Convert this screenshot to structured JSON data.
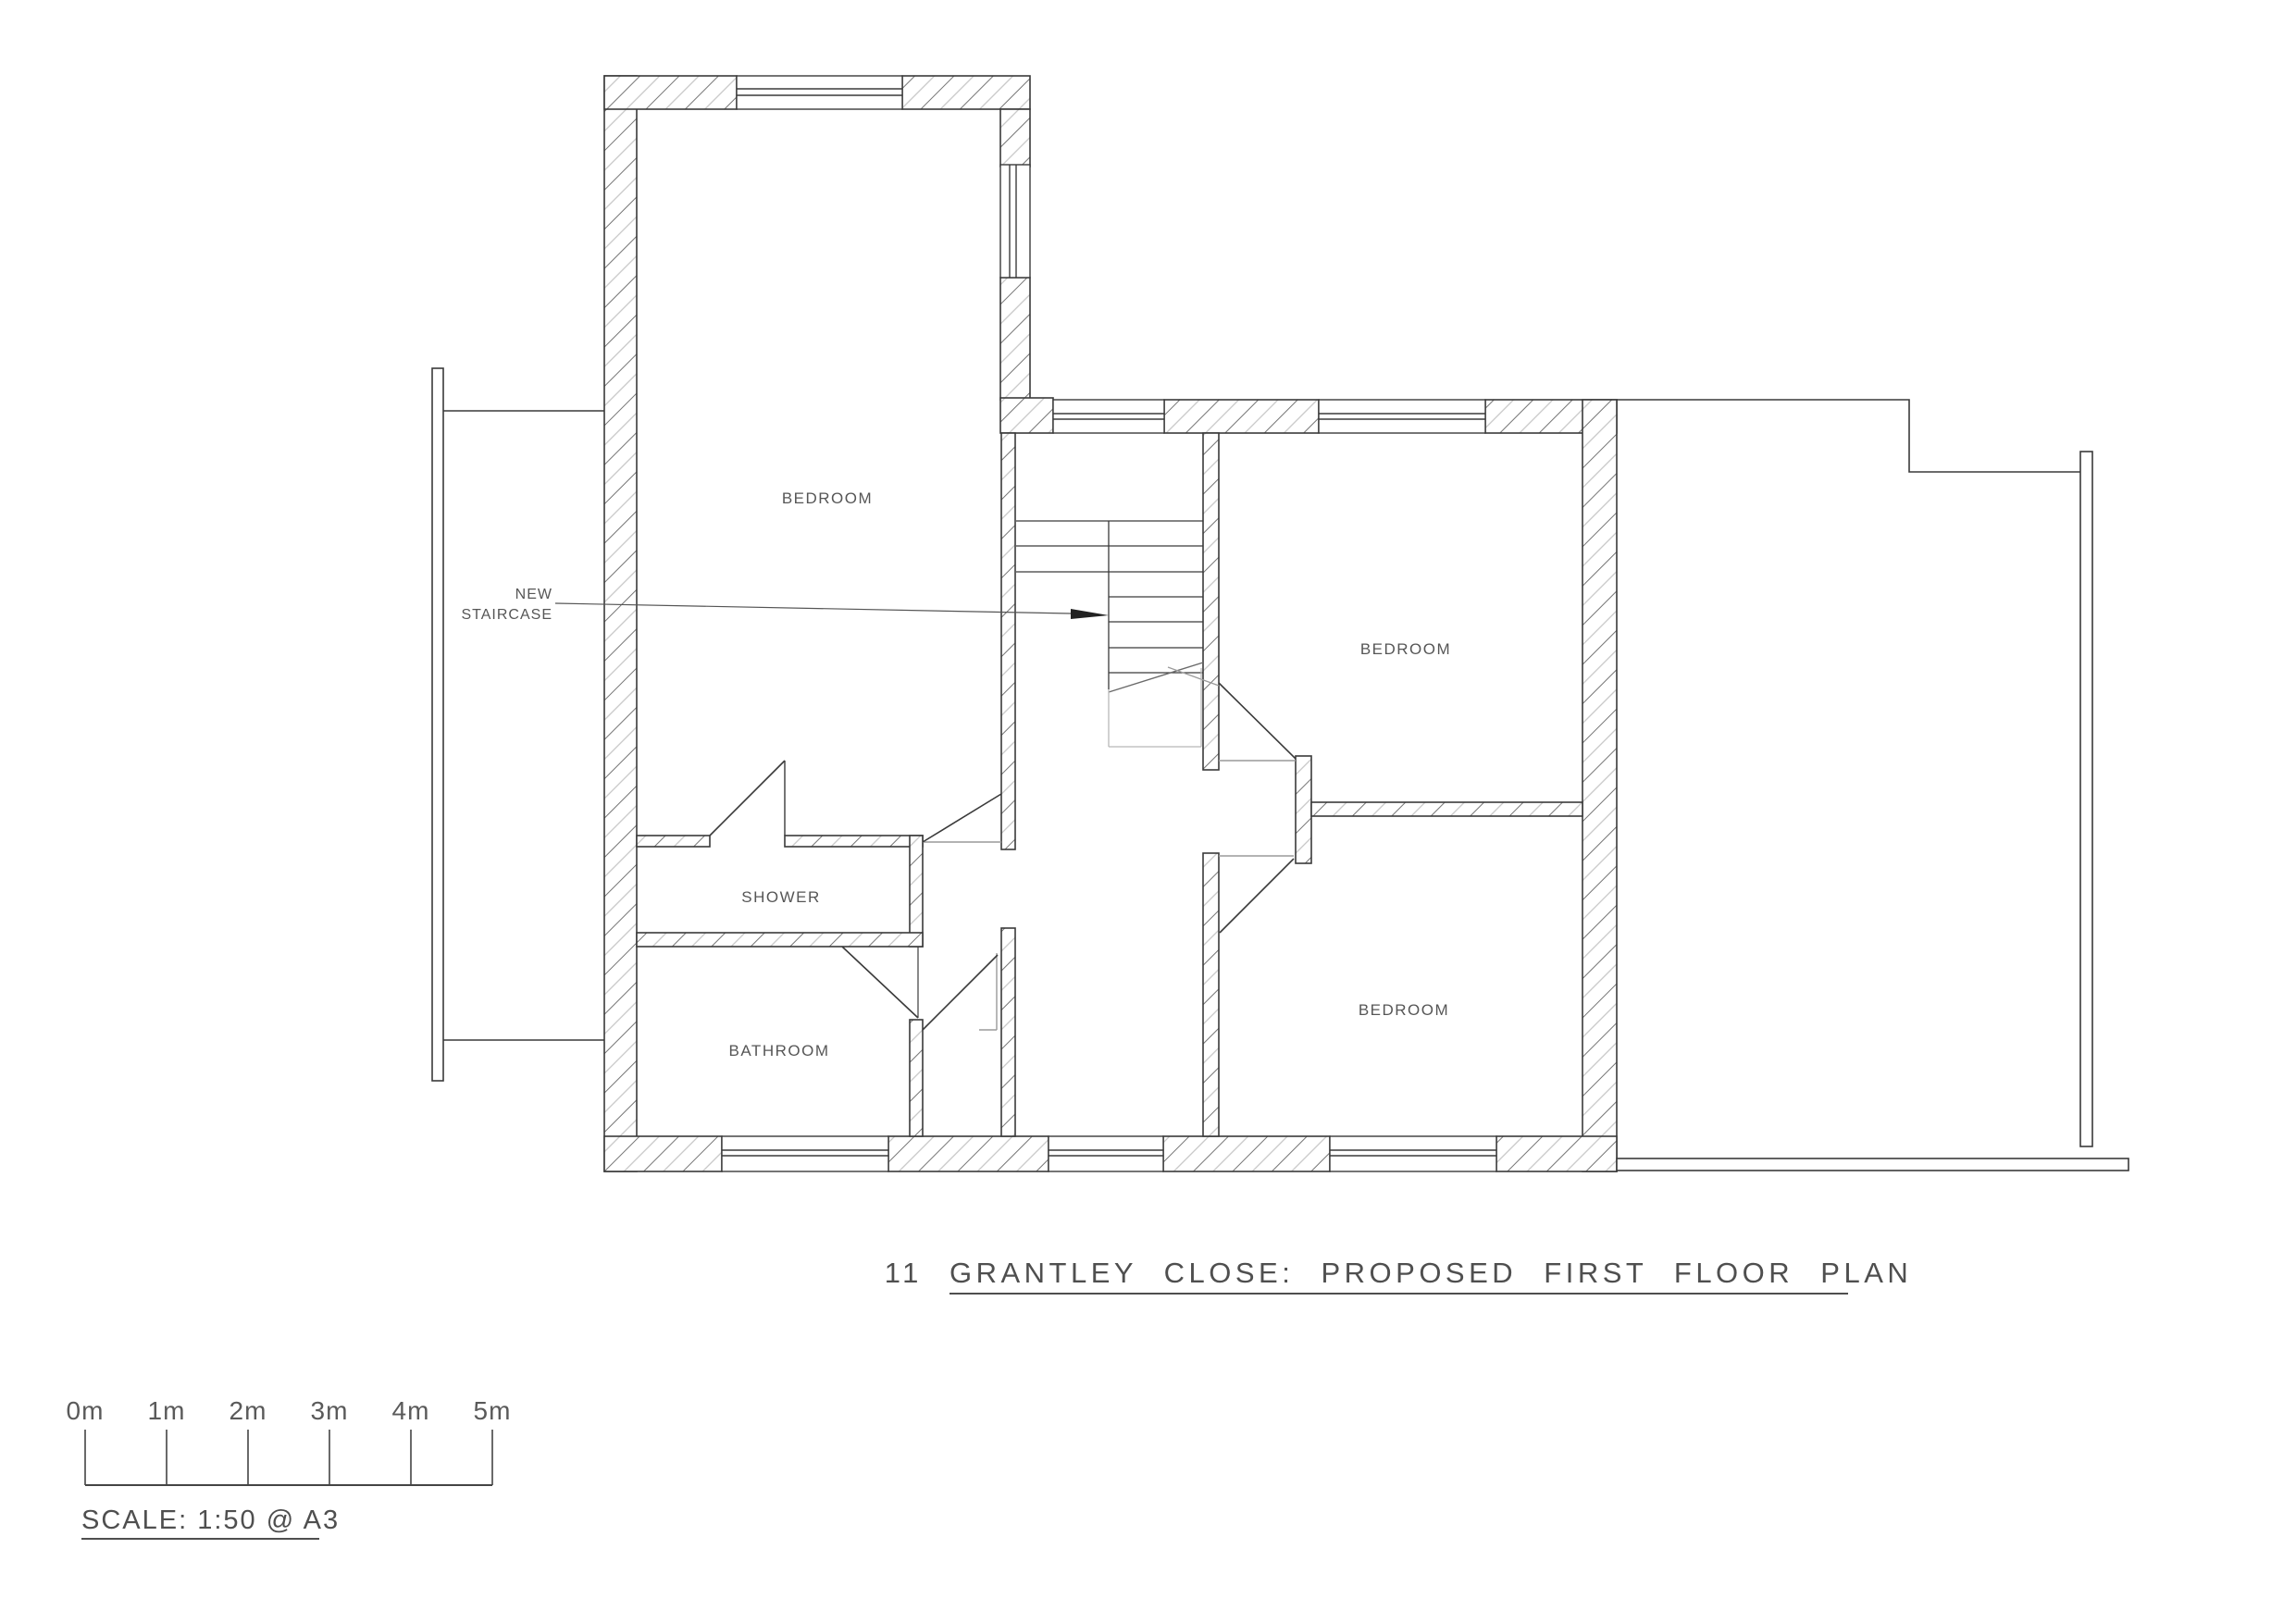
{
  "drawing": {
    "title": "11 GRANTLEY CLOSE: PROPOSED FIRST FLOOR PLAN",
    "type": "architectural floor plan"
  },
  "rooms": {
    "bedroom_main": {
      "label": "BEDROOM"
    },
    "bedroom_right_top": {
      "label": "BEDROOM"
    },
    "bedroom_right_bottom": {
      "label": "BEDROOM"
    },
    "shower": {
      "label": "SHOWER"
    },
    "bathroom": {
      "label": "BATHROOM"
    }
  },
  "annotations": {
    "new_staircase_line1": "NEW",
    "new_staircase_line2": "STAIRCASE"
  },
  "scale_bar": {
    "labels": [
      "0m",
      "1m",
      "2m",
      "3m",
      "4m",
      "5m"
    ],
    "caption": "SCALE: 1:50 @ A3"
  },
  "colors": {
    "background": "#ffffff",
    "wall_line": "#3a3a3a",
    "thin_line": "#555555",
    "gray_line": "#9a9a9a",
    "light_gray_line": "#b8b8b8",
    "hatch_dark": "#757575",
    "hatch_light": "#c6c6c6",
    "text": "#565656"
  }
}
